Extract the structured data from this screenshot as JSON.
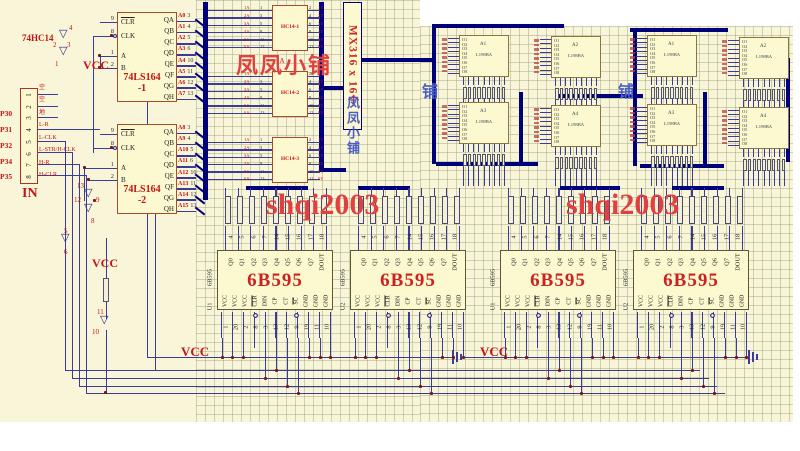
{
  "palette": {
    "sheet": "#f9f5d8",
    "bus": "#00007a",
    "wire": "#3b3b99",
    "chip_fill": "#fcf8cf",
    "chip_border": "#a84c28",
    "red_text": "#c41414",
    "watermark_red": "#e04040",
    "cjk_blue": "#4a5ec8"
  },
  "watermarks": {
    "fengfeng": "凤凤小铺",
    "mx316": "MX316 x 16个",
    "fengfeng_v": "凤凤小铺",
    "shqi": "shqi2003",
    "pu": "铺",
    "label_1a": "1A"
  },
  "left_section": {
    "hc14_ref": "74HC14",
    "vcc_top": "VCC",
    "vcc_mid": "VCC",
    "in_label": "IN",
    "connector_pins": [
      {
        "num": "1",
        "net": "空",
        "port": ""
      },
      {
        "num": "2",
        "net": "空",
        "port": ""
      },
      {
        "num": "3",
        "net": "地",
        "port": ""
      },
      {
        "num": "4",
        "net": "L-R",
        "port": "P30"
      },
      {
        "num": "5",
        "net": "L-CLK",
        "port": "P31"
      },
      {
        "num": "6",
        "net": "L-STR/H-CLK",
        "port": "P32"
      },
      {
        "num": "7",
        "net": "H-R",
        "port": "P34"
      },
      {
        "num": "8",
        "net": "H-CLR",
        "port": "P35"
      }
    ],
    "inv": {
      "top": [
        "4",
        "3",
        "2",
        "1"
      ],
      "mid": [
        "13",
        "12",
        "9",
        "8"
      ],
      "low": [
        "5",
        "6"
      ],
      "bot": [
        "11",
        "10"
      ]
    }
  },
  "ls164": {
    "chips": [
      {
        "title": "74LS164",
        "sub": "-1"
      },
      {
        "title": "74LS164",
        "sub": "-2"
      }
    ],
    "left_pins": [
      {
        "num": "9",
        "label": "CLR"
      },
      {
        "num": "8",
        "label": "CLK"
      },
      {
        "num": "1",
        "label": "A"
      },
      {
        "num": "2",
        "label": "B"
      }
    ],
    "out_labels": [
      "QA",
      "QB",
      "QC",
      "QD",
      "QE",
      "QF",
      "QG",
      "QH"
    ],
    "nets1": [
      {
        "net": "A0",
        "num": "3"
      },
      {
        "net": "A1",
        "num": "4"
      },
      {
        "net": "A2",
        "num": "5"
      },
      {
        "net": "A3",
        "num": "6"
      },
      {
        "net": "A4",
        "num": "10"
      },
      {
        "net": "A5",
        "num": "11"
      },
      {
        "net": "A6",
        "num": "12"
      },
      {
        "net": "A7",
        "num": "13"
      }
    ],
    "nets2": [
      {
        "net": "A8",
        "num": "3"
      },
      {
        "net": "A9",
        "num": "4"
      },
      {
        "net": "A10",
        "num": "5"
      },
      {
        "net": "A11",
        "num": "6"
      },
      {
        "net": "A12",
        "num": "10"
      },
      {
        "net": "A13",
        "num": "11"
      },
      {
        "net": "A14",
        "num": "12"
      },
      {
        "net": "A15",
        "num": "13"
      }
    ]
  },
  "hc14": {
    "chips": [
      {
        "name": "HC14-1"
      },
      {
        "name": "HC14-2"
      },
      {
        "name": "HC14-3"
      }
    ],
    "left_nums": [
      "1",
      "3",
      "5",
      "9",
      "11",
      "13"
    ],
    "left_labels": [
      "1A",
      "2A",
      "3A",
      "4A",
      "5A",
      "6A"
    ],
    "right_nums": [
      "2",
      "4",
      "6",
      "8",
      "10",
      "12"
    ],
    "right_labels": [
      "1Y",
      "2Y",
      "3Y",
      "4Y",
      "5Y",
      "6Y"
    ]
  },
  "modules": {
    "items": [
      {
        "des": "A1"
      },
      {
        "des": "A2"
      },
      {
        "des": "A3"
      },
      {
        "des": "A4"
      },
      {
        "des": "A1"
      },
      {
        "des": "A2"
      },
      {
        "des": "A3"
      },
      {
        "des": "A4"
      }
    ],
    "part": "L198BA",
    "left_labels": [
      "O1",
      "O2",
      "O3",
      "O4",
      "O5",
      "O6",
      "O7",
      "O8"
    ],
    "nine": [
      "",
      "",
      "",
      "",
      "",
      "",
      "",
      "",
      ""
    ]
  },
  "drivers": {
    "items": [
      {
        "des": "U1"
      },
      {
        "des": "U2"
      },
      {
        "des": "U1"
      },
      {
        "des": "U2"
      }
    ],
    "part": "6B595",
    "big": "6B595",
    "top_labels": [
      "Q0",
      "Q1",
      "Q2",
      "Q3",
      "Q4",
      "Q5",
      "Q6",
      "Q7",
      "DOUT"
    ],
    "top_nums": [
      "4",
      "5",
      "6",
      "7",
      "14",
      "15",
      "16",
      "17",
      "18"
    ],
    "bottom_labels": [
      "VCC",
      "VCC",
      "VCC",
      "CLR",
      "DIN",
      "CP",
      "CT",
      "SC",
      "GND",
      "GND",
      "GND"
    ],
    "bottom_nums": [
      "1",
      "20",
      "2",
      "8",
      "3",
      "13",
      "12",
      "9",
      "19",
      "11",
      "10"
    ]
  },
  "bottom": {
    "vcc_left": "VCC",
    "vcc_right": "VCC"
  }
}
